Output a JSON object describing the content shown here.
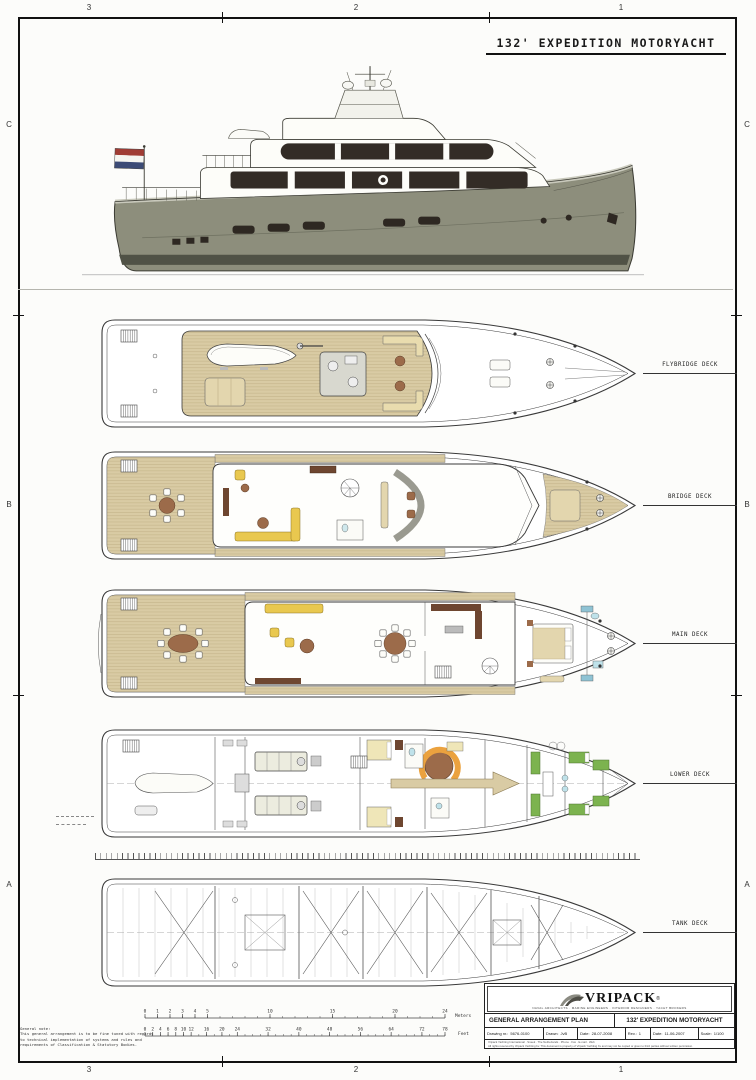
{
  "sheet": {
    "title": "132' EXPEDITION MOTORYACHT",
    "border": {
      "column_labels": [
        "3",
        "2",
        "1"
      ],
      "row_labels": [
        "C",
        "B",
        "A"
      ]
    }
  },
  "decks": [
    {
      "label": "FLYBRIDGE DECK"
    },
    {
      "label": "BRIDGE DECK"
    },
    {
      "label": "MAIN DECK"
    },
    {
      "label": "LOWER DECK"
    },
    {
      "label": "TANK DECK"
    }
  ],
  "scales": {
    "meters": {
      "unit": "Meters",
      "max": 24,
      "ticks": [
        0,
        1,
        2,
        3,
        4,
        5,
        10,
        15,
        20,
        24
      ]
    },
    "feet": {
      "unit": "Feet",
      "max": 78,
      "ticks": [
        0,
        2,
        4,
        6,
        8,
        10,
        12,
        16,
        20,
        24,
        32,
        40,
        48,
        56,
        64,
        72,
        78
      ]
    }
  },
  "notes": {
    "heading": "General note:",
    "lines": [
      "This general arrangement is to be fine tuned with regards",
      "to technical implementation of systems and rules and",
      "requirements of Classification & Statutory Bodies."
    ]
  },
  "title_block": {
    "brand": "VRIPACK",
    "registered": "®",
    "tagline": "NAVAL ARCHITECTS · MARINE ENGINEERS · INTERIOR DESIGNERS · YACHT BROKERS",
    "plan_title": "GENERAL ARRANGEMENT PLAN",
    "project_title": "132' EXPEDITION MOTORYACHT",
    "fields": [
      {
        "label": "Drawing nr.:",
        "value": "5676-0100"
      },
      {
        "label": "Drawn:",
        "value": "JvB"
      },
      {
        "label": "Date:",
        "value": "28-07-2008"
      },
      {
        "label": "Rev.:",
        "value": "1"
      },
      {
        "label": "Date:",
        "value": "11-06-2007"
      },
      {
        "label": "Scale:",
        "value": "1/100"
      }
    ],
    "fine_print": [
      "Vripack Yachting International · Sneek · The Netherlands · Phone · Fax · E-mail · Web",
      "All rights reserved by Vripack Yachting bv. This document is property of Vripack Yachting bv and may not be copied or given to third parties without written permission."
    ]
  },
  "colors": {
    "hull_olive": "#8d8e7c",
    "window_band": "#332c26",
    "teak": "#d9cba4",
    "sofa_yellow": "#e9c84f",
    "wood_brown": "#9c6b4a",
    "cabinet_dark": "#6e4630",
    "bed_green": "#7cb34f",
    "fixture_cyan": "#bfe2ea",
    "sofa_orange": "#eba23f",
    "skylight_blue": "#8fc3d4"
  }
}
